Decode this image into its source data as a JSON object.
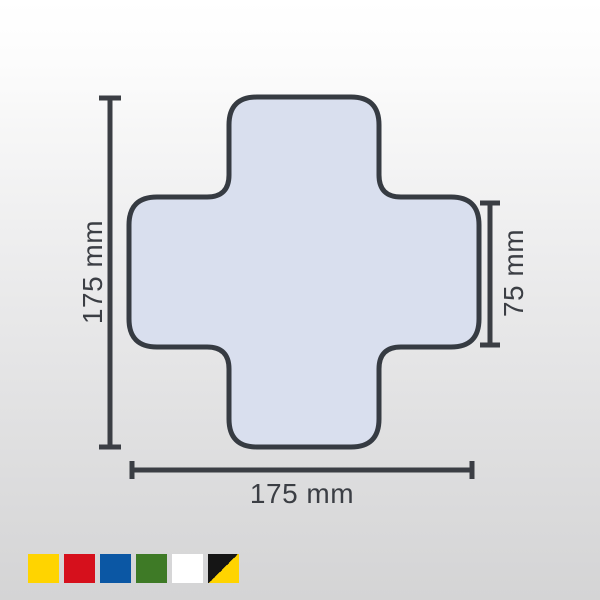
{
  "diagram": {
    "shape": "cross",
    "fill_color": "#d9dfee",
    "outline_color": "#363b42",
    "dimension_color": "#3b3e44",
    "labels": {
      "overall_height": "175 mm",
      "arm_width": "75 mm",
      "overall_width": "175 mm"
    }
  },
  "swatches": [
    {
      "name": "yellow",
      "color": "#ffd400"
    },
    {
      "name": "red",
      "color": "#d6101c"
    },
    {
      "name": "blue",
      "color": "#0b57a4"
    },
    {
      "name": "green",
      "color": "#3e7a26"
    },
    {
      "name": "white",
      "color": "#ffffff"
    },
    {
      "name": "black-yellow",
      "color": "#151515",
      "color2": "#ffd400"
    }
  ]
}
